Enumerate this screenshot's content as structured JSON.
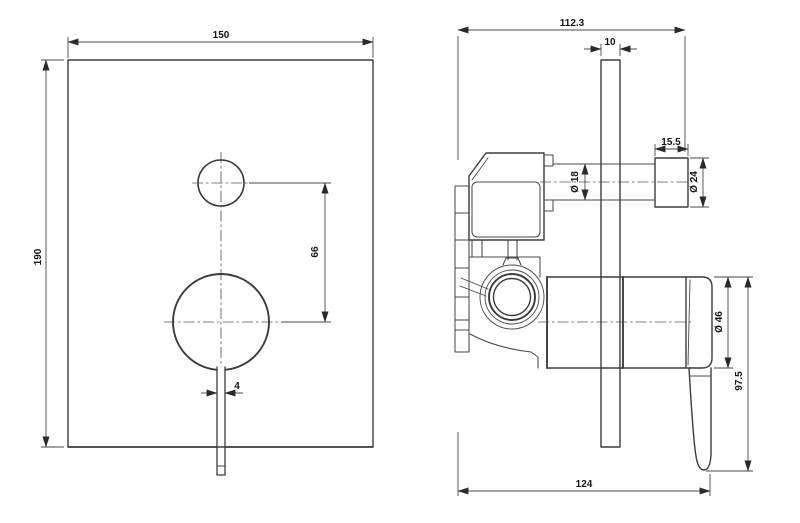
{
  "drawing": {
    "type": "technical-dimension-drawing",
    "subject": "concealed-shower-mixer",
    "views": {
      "front": {
        "width": "150",
        "height": "190",
        "hole_spacing": "66",
        "lever_width": "4"
      },
      "side": {
        "overall_depth": "112.3",
        "plate_thickness": "10",
        "knob_length": "15.5",
        "stem_diameter": "Ø 18",
        "knob_diameter": "Ø 24",
        "handle_diameter": "Ø 46",
        "handle_length": "97.5",
        "total_depth": "124"
      }
    },
    "colors": {
      "background": "#ffffff",
      "outline": "#3c3c3c",
      "dimension_lines": "#4a4a4a",
      "text": "#151515"
    }
  }
}
